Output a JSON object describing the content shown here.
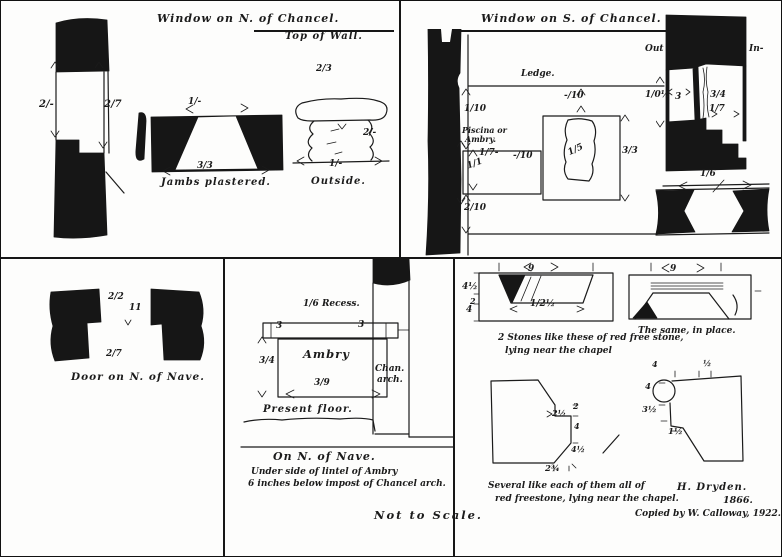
{
  "ink": "#1b1b1b",
  "paper": "#fdfdfc",
  "north_window": {
    "title": "Window on N. of Chancel.",
    "top_of_wall": "Top of Wall.",
    "jamb_left": "2/-",
    "jamb_right": "2/7",
    "splay_top": "1/-",
    "splay_bottom": "3/3",
    "splay_caption": "Jambs plastered.",
    "outside_top": "2/3",
    "outside_right": "2/-",
    "outside_bottom": "1/-",
    "outside_caption": "Outside."
  },
  "south_window": {
    "title": "Window on S. of Chancel.",
    "ledge": "Ledge.",
    "dim_upper": "1/10",
    "piscina_line1": "Piscina or",
    "piscina_line2": "Ambry.",
    "piscina_width": "1/7-",
    "piscina_height": "1/1",
    "piscina_side": "-/10",
    "dim_lower": "2/10",
    "window_top": "-/10",
    "window_inner": "1/5",
    "window_side": "3/3",
    "out": "Out",
    "in": "In-",
    "wall_thickness": "1/0½",
    "dim_a": "3",
    "dim_b": "3/4",
    "dim_c": "1/7",
    "sill_width": "1/6"
  },
  "nave_door": {
    "dim_top": "2/2",
    "dim_mid": "11",
    "dim_bottom": "2/7",
    "caption": "Door on N. of Nave."
  },
  "ambry": {
    "recess": "1/6 Recess.",
    "lintel_left": "3",
    "lintel_right": "3",
    "name": "Ambry",
    "dim_left": "3/4",
    "dim_bottom": "3/9",
    "arch_line1": "Chan.",
    "arch_line2": "arch.",
    "floor": "Present floor.",
    "caption1": "On N. of Nave.",
    "caption2": "Under side of lintel of Ambry",
    "caption3": "6 inches below impost of Chancel arch."
  },
  "stones": {
    "s1_top": "9",
    "s1_d1": "4½",
    "s1_d2": "2",
    "s1_d3": "4",
    "s1_inner": "1/2½",
    "s1_caption1": "2 Stones like these of red free stone,",
    "s1_caption2": "lying near the chapel",
    "s2_top": "9",
    "s2_caption": "The same, in place.",
    "s3_notch": "2½",
    "s3_r1": "2",
    "s3_r2": "4",
    "s3_r3": "4½",
    "s3_bottom": "2¾",
    "s3_caption1": "Several like each of them all of",
    "s3_caption2": "red freestone, lying near the chapel.",
    "s4_t1": "4",
    "s4_t2": "½",
    "s4_l1": "4",
    "s4_l2": "3½",
    "s4_l3": "1½",
    "signature": "H. Dryden.",
    "year": "1866.",
    "copied_by": "Copied by W. Calloway, 1922."
  },
  "note": "Not to Scale."
}
